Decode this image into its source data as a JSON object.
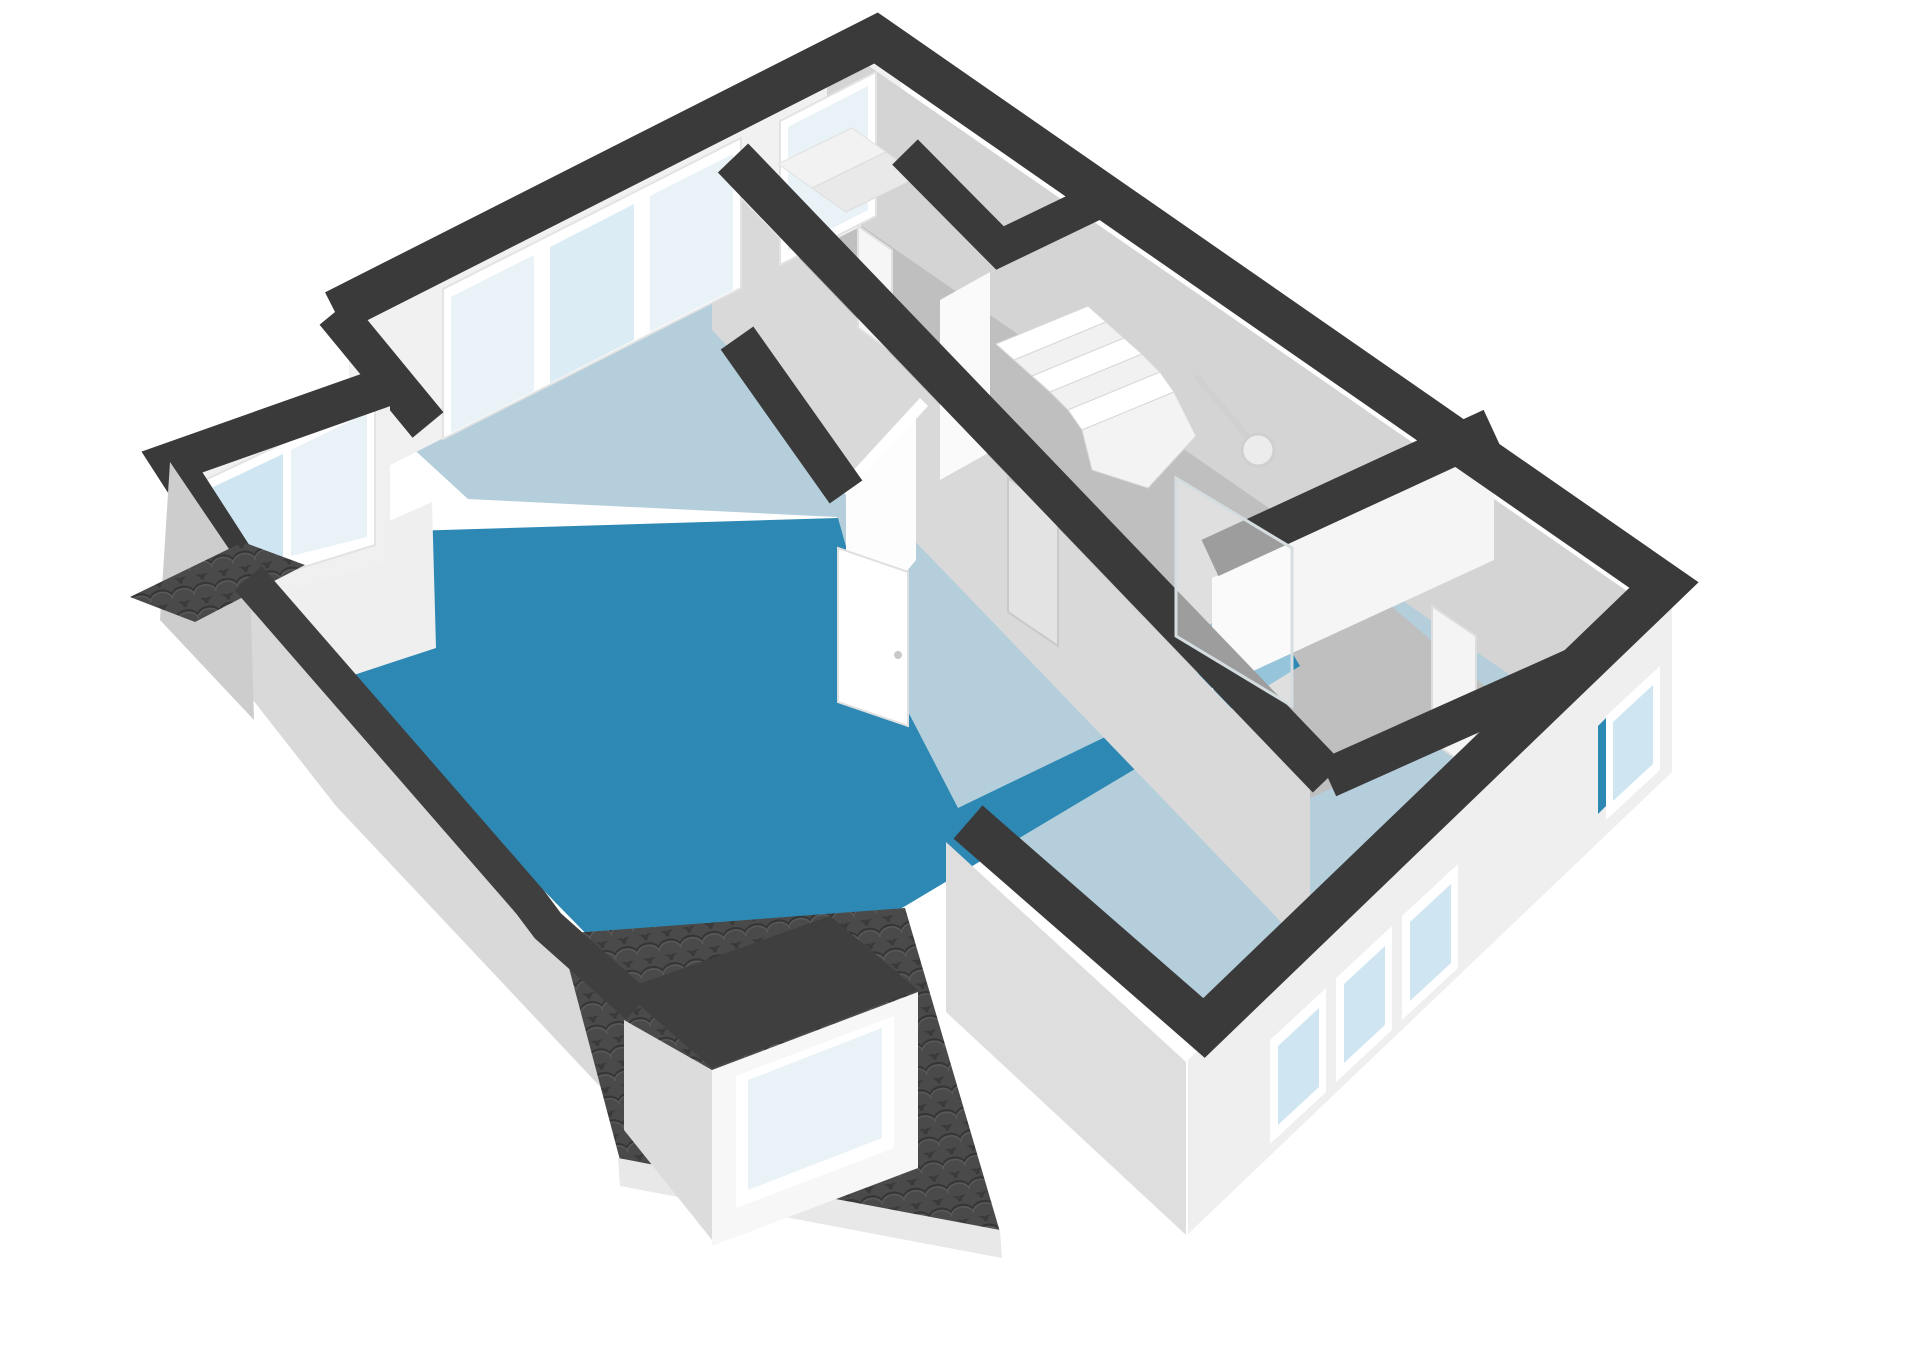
{
  "scene": {
    "width": 1920,
    "height": 1358,
    "background": "#ffffff",
    "view": "3d-floorplan-axonometric"
  },
  "palette": {
    "wall_top_band": "#3a3a3a",
    "wall_top_band_light": "#3f3f3f",
    "interior_wall_bright": "#fafafa",
    "interior_wall_light": "#f1f1f1",
    "interior_wall_shaded": "#d9d9d9",
    "interior_wall_gray": "#d4d4d4",
    "exterior_wall_bright": "#efefef",
    "exterior_wall_mid": "#dedede",
    "exterior_wall_dark": "#cdcdcd",
    "floor_room_blue": "#b5cedb",
    "floor_hall_gray": "#bfbfbf",
    "floor_balcony_blue": "#2d89b4",
    "window_glass": "#e9f2f6",
    "window_glass_blue": "#cfe6f2",
    "roof_tiles": "#4a4a4a",
    "white": "#ffffff"
  },
  "shapes": [
    {
      "name": "floor-slab-bedrooms",
      "kind": "polygon",
      "pts": "395,432 900,185 1620,762 1186,1020 955,806 873,645 837,517 468,499",
      "fill": "#b5cedb"
    },
    {
      "name": "floor-hallway-landing",
      "kind": "polygon",
      "pts": "700,152 900,186 1508,706 1302,802 1062,626 838,333",
      "fill": "#bfbfbf"
    },
    {
      "name": "floor-balcony",
      "kind": "polygon",
      "pts": "240,562 312,534 838,518 874,646 958,808 1128,726 1150,760 902,908 660,1002 600,948 246,586",
      "fill": "#2d89b4"
    },
    {
      "name": "floor-shower-wet-area",
      "kind": "polygon",
      "pts": "1180,642 1258,596 1300,666 1222,714",
      "fill": "#2d89b4"
    },
    {
      "name": "wall-face-northwest-interior",
      "kind": "polygon",
      "pts": "349,321 901,41 901,206 349,486",
      "fill": "#f1f1f1"
    },
    {
      "name": "wall-face-northeast-interior",
      "kind": "polygon",
      "pts": "827,37 1650,607 1650,772 827,202",
      "fill": "#d4d4d4"
    },
    {
      "name": "wall-face-hallway-long",
      "kind": "polygon",
      "pts": "712,168 1310,790 1310,952 712,330",
      "fill": "#d9d9d9"
    },
    {
      "name": "wall-face-bathroom-north",
      "kind": "polygon",
      "pts": "1212,578 1494,448 1494,560 1212,690",
      "fill": "#f5f5f5"
    },
    {
      "name": "wall-stub-stairwell",
      "kind": "polygon",
      "pts": "940,300 990,272 990,452 940,480",
      "fill": "#fafafa"
    },
    {
      "name": "wall-stub-bedroom-divider",
      "kind": "polygon",
      "pts": "846,492 916,406 916,560 846,646",
      "fill": "#fdfdfd"
    },
    {
      "name": "wall-stub-bedroom-divider-top",
      "kind": "polygon",
      "pts": "838,487 920,398 928,406 846,495",
      "fill": "#ffffff"
    },
    {
      "name": "wall-face-balcony-west",
      "kind": "polygon",
      "pts": "252,582 432,502 436,648 302,692",
      "fill": "#efefef"
    },
    {
      "name": "window-frame-bedroom-nw",
      "kind": "polygon",
      "pts": "443,289 741,138 741,288 443,439",
      "fill": "#ffffff",
      "stroke": "#e3e3e3",
      "sw": 2
    },
    {
      "name": "window-glass-bedroom-nw-1",
      "kind": "polygon",
      "pts": "451,297 534,255 534,391 451,433",
      "fill": "#e9f2f6"
    },
    {
      "name": "window-glass-bedroom-nw-2",
      "kind": "polygon",
      "pts": "550,247 634,204 634,340 550,383",
      "fill": "#dcecf4"
    },
    {
      "name": "window-glass-bedroom-nw-3",
      "kind": "polygon",
      "pts": "650,196 733,154 733,290 650,332",
      "fill": "#e9f2f6"
    },
    {
      "name": "window-frame-toproom-nw",
      "kind": "polygon",
      "pts": "780,121 876,72 876,216 780,265",
      "fill": "#ffffff",
      "stroke": "#e3e3e3",
      "sw": 2
    },
    {
      "name": "window-glass-toproom-nw",
      "kind": "polygon",
      "pts": "788,127 868,86 868,210 788,251",
      "fill": "#e9f2f6"
    },
    {
      "name": "door-hallway",
      "kind": "polygon",
      "pts": "1008,478 1058,512 1058,646 1008,612",
      "fill": "#e3e3e3",
      "stroke": "#c9c9c9",
      "sw": 2
    },
    {
      "name": "door-toproom",
      "kind": "polygon",
      "pts": "858,226 892,250 892,352 858,328",
      "fill": "#f6f6f6",
      "stroke": "#e0e0e0",
      "sw": 2
    },
    {
      "name": "door-bathroom",
      "kind": "polygon",
      "pts": "1432,606 1476,636 1476,772 1432,742",
      "fill": "#f4f4f4",
      "stroke": "#dddddd",
      "sw": 2
    },
    {
      "name": "furniture-bench-1",
      "kind": "polygon",
      "pts": "778,164 852,128 886,152 812,188",
      "fill": "#f2f2f2",
      "stroke": "#e2e2e2",
      "sw": 1
    },
    {
      "name": "furniture-bench-2",
      "kind": "polygon",
      "pts": "812,188 886,152 920,176 846,212",
      "fill": "#e9e9e9",
      "stroke": "#dcdcdc",
      "sw": 1
    },
    {
      "name": "stair-tread-1",
      "kind": "polygon",
      "pts": "996,344 1088,306 1106,322 1014,360",
      "fill": "#ffffff",
      "stroke": "#d8d8d8",
      "sw": 1
    },
    {
      "name": "stair-tread-2",
      "kind": "polygon",
      "pts": "1014,360 1106,322 1124,338 1032,376",
      "fill": "#f1f1f1",
      "stroke": "#d8d8d8",
      "sw": 1
    },
    {
      "name": "stair-tread-3",
      "kind": "polygon",
      "pts": "1032,376 1124,338 1142,354 1050,392",
      "fill": "#ffffff",
      "stroke": "#d8d8d8",
      "sw": 1
    },
    {
      "name": "stair-tread-4",
      "kind": "polygon",
      "pts": "1050,392 1142,354 1160,372 1068,410",
      "fill": "#f1f1f1",
      "stroke": "#d8d8d8",
      "sw": 1
    },
    {
      "name": "stair-tread-5",
      "kind": "polygon",
      "pts": "1068,410 1160,372 1174,392 1082,430",
      "fill": "#ffffff",
      "stroke": "#d8d8d8",
      "sw": 1
    },
    {
      "name": "stair-winder",
      "kind": "polygon",
      "pts": "1082,430 1174,392 1196,436 1148,488 1092,470",
      "fill": "#f3f3f3",
      "stroke": "#d8d8d8",
      "sw": 1
    },
    {
      "name": "wallband-hallway-long",
      "kind": "polyline",
      "pts": "733,158 1328,778",
      "stroke": "#3a3a3a",
      "sw": 42
    },
    {
      "name": "wallband-bedroom-divider",
      "kind": "polyline",
      "pts": "737,338 846,492",
      "stroke": "#3a3a3a",
      "sw": 40
    },
    {
      "name": "wallband-bathroom-nw",
      "kind": "polyline",
      "pts": "1210,558 1492,428",
      "stroke": "#3a3a3a",
      "sw": 40
    },
    {
      "name": "wallband-bathroom-se",
      "kind": "polyline",
      "pts": "1328,778 1625,645",
      "stroke": "#3a3a3a",
      "sw": 40
    },
    {
      "name": "wallband-closet",
      "kind": "polyline",
      "pts": "905,152 1000,248 1108,196",
      "stroke": "#3a3a3a",
      "sw": 36
    },
    {
      "name": "wallband-bedroom-west",
      "kind": "polyline",
      "pts": "335,312 428,425",
      "stroke": "#3a3a3a",
      "sw": 40
    },
    {
      "name": "shower-arm",
      "kind": "line",
      "x1": 1196,
      "y1": 376,
      "x2": 1254,
      "y2": 444,
      "stroke": "#d0d0d0",
      "sw": 6
    },
    {
      "name": "shower-head",
      "kind": "circle",
      "cx": 1258,
      "cy": 450,
      "r": 16,
      "fill": "#ececec",
      "stroke": "#cfcfcf",
      "sw": 3
    },
    {
      "name": "shower-glass-screen",
      "kind": "polygon",
      "pts": "1176,478 1292,548 1292,706 1176,636",
      "fill": "rgba(255,255,255,0.5)",
      "stroke": "#d5dde0",
      "sw": 3
    },
    {
      "name": "wall-face-annex-window-wall",
      "kind": "polygon",
      "pts": "190,470 390,390 390,560 230,610",
      "fill": "#f0f0f0"
    },
    {
      "name": "window-frame-annex",
      "kind": "polygon",
      "pts": "205,480 375,400 375,545 223,592",
      "fill": "#ffffff",
      "stroke": "#e3e3e3",
      "sw": 2
    },
    {
      "name": "window-glass-annex-1",
      "kind": "polygon",
      "pts": "213,487 283,454 283,560 219,583",
      "fill": "#cfe6f2"
    },
    {
      "name": "window-glass-annex-2",
      "kind": "polygon",
      "pts": "291,450 367,413 367,537 291,556",
      "fill": "#e9f2f6"
    },
    {
      "name": "annex-sink",
      "kind": "circle",
      "cx": 272,
      "cy": 600,
      "r": 13,
      "fill": "#f6f6f6",
      "stroke": "#d0d0d0",
      "sw": 3
    },
    {
      "name": "wallband-annex",
      "kind": "polyline",
      "pts": "404,380 172,462 248,580",
      "stroke": "#3a3a3a",
      "sw": 40
    },
    {
      "name": "exterior-face-parapet",
      "kind": "polygon",
      "pts": "206,640 232,572 624,1002 624,1112 336,806",
      "fill": "#d9d9d9"
    },
    {
      "name": "exterior-face-annex-west",
      "kind": "polygon",
      "pts": "170,462 250,580 254,720 160,620",
      "fill": "#cdcdcd"
    },
    {
      "name": "exterior-face-wing-southwest",
      "kind": "polygon",
      "pts": "946,842 1186,1062 1186,1235 946,1012",
      "fill": "#dedede"
    },
    {
      "name": "exterior-face-wing-southeast",
      "kind": "polygon",
      "pts": "1188,1060 1672,598 1672,772 1188,1234",
      "fill": "#efefef"
    },
    {
      "name": "window-frame-wing-1",
      "kind": "polygon",
      "pts": "1270,1040 1326,988 1326,1092 1270,1144",
      "fill": "#ffffff"
    },
    {
      "name": "window-glass-wing-1",
      "kind": "polygon",
      "pts": "1278,1046 1319,1008 1319,1087 1278,1125",
      "fill": "#cfe6f2"
    },
    {
      "name": "window-frame-wing-2",
      "kind": "polygon",
      "pts": "1336,978 1392,926 1392,1030 1336,1082",
      "fill": "#ffffff"
    },
    {
      "name": "window-glass-wing-2",
      "kind": "polygon",
      "pts": "1344,984 1385,946 1385,1025 1344,1063",
      "fill": "#cfe6f2"
    },
    {
      "name": "window-frame-wing-3",
      "kind": "polygon",
      "pts": "1402,916 1458,864 1458,968 1402,1020",
      "fill": "#ffffff"
    },
    {
      "name": "window-glass-wing-3",
      "kind": "polygon",
      "pts": "1410,922 1451,884 1451,963 1410,1001",
      "fill": "#cfe6f2"
    },
    {
      "name": "window-accent-east-blue",
      "kind": "polygon",
      "pts": "1598,726 1612,712 1612,800 1598,814",
      "fill": "#2d89b4"
    },
    {
      "name": "window-frame-east",
      "kind": "polygon",
      "pts": "1606,716 1660,666 1660,770 1606,820",
      "fill": "#ffffff"
    },
    {
      "name": "window-glass-east",
      "kind": "polygon",
      "pts": "1613,722 1653,685 1653,764 1613,801",
      "fill": "#cfe6f2"
    },
    {
      "name": "roof-slope-west",
      "kind": "polygon",
      "pts": "130,597 243,542 305,565 195,622",
      "fill": "url(#tiles)"
    },
    {
      "name": "roof-slope-main",
      "kind": "polygon",
      "pts": "560,934 905,908 1000,1232 620,1160",
      "fill": "url(#tiles)"
    },
    {
      "name": "roof-eaves-fascia",
      "kind": "polygon",
      "pts": "618,1158 1000,1230 1002,1258 620,1186",
      "fill": "#e8e8e8"
    },
    {
      "name": "dormer-roof-top",
      "kind": "polygon",
      "pts": "622,990 712,1068 918,990 830,916",
      "fill": "#3f3f3f"
    },
    {
      "name": "dormer-face-southeast",
      "kind": "polygon",
      "pts": "712,1070 918,992 918,1168 712,1246",
      "fill": "#f7f7f7"
    },
    {
      "name": "dormer-face-southwest",
      "kind": "polygon",
      "pts": "624,1020 712,1070 712,1240 624,1130",
      "fill": "#dcdcdc"
    },
    {
      "name": "dormer-window-frame",
      "kind": "polygon",
      "pts": "736,1076 894,1016 894,1148 736,1208",
      "fill": "#ffffff"
    },
    {
      "name": "dormer-window-glass",
      "kind": "polygon",
      "pts": "748,1080 882,1028 882,1138 748,1190",
      "fill": "#e9f2f6"
    },
    {
      "name": "door-balcony",
      "kind": "polygon",
      "pts": "838,548 908,572 908,726 838,702",
      "fill": "#ffffff",
      "stroke": "#e0e0e0",
      "sw": 2
    },
    {
      "name": "door-balcony-handle",
      "kind": "circle",
      "cx": 898,
      "cy": 655,
      "r": 4,
      "fill": "#c9c9c9"
    },
    {
      "name": "wallband-perimeter",
      "kind": "polyline",
      "pts": "335,312 876,38 1664,585 1204,1028 968,822",
      "stroke": "#3a3a3a",
      "sw": 44
    },
    {
      "name": "wallband-balcony-parapet",
      "kind": "polyline",
      "pts": "248,578 530,902 548,926 638,1006",
      "stroke": "#3f3f3f",
      "sw": 36
    }
  ]
}
